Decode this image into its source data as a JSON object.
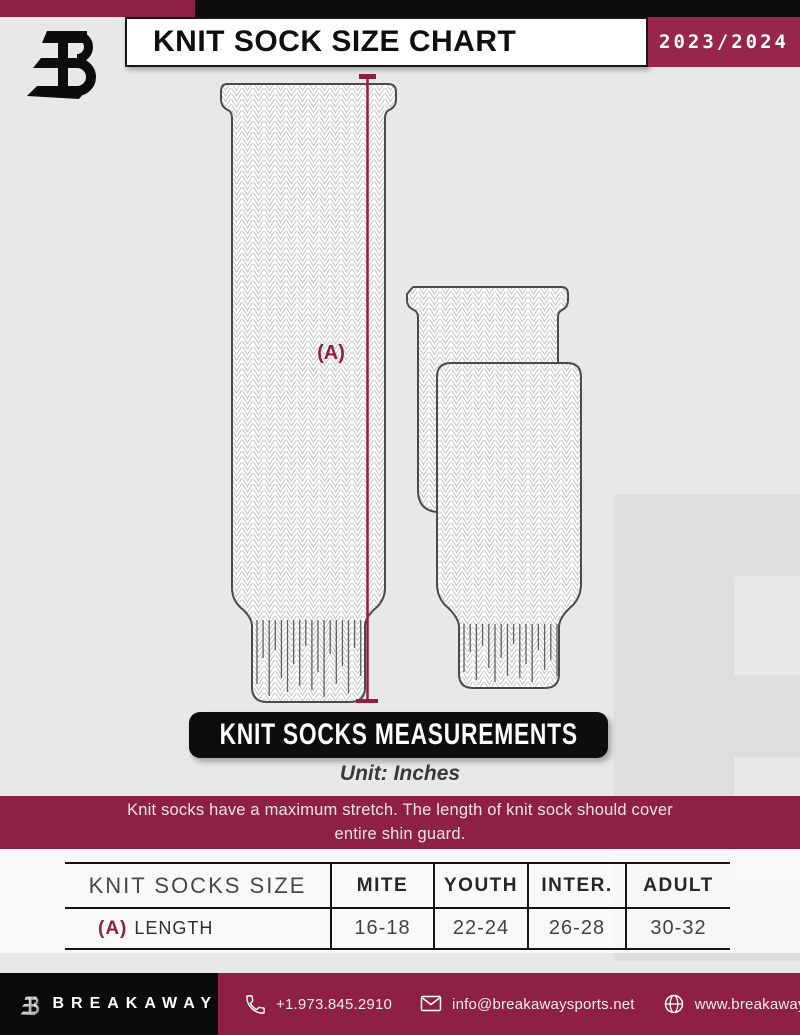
{
  "header": {
    "title": "KNIT SOCK SIZE CHART",
    "season": "2023/2024"
  },
  "diagram": {
    "measurement_label": "(A)"
  },
  "section": {
    "banner": "KNIT SOCKS MEASUREMENTS",
    "unit": "Unit: Inches",
    "note_lines": [
      "Knit socks have a maximum stretch. The length of knit sock should cover",
      "entire shin guard."
    ]
  },
  "table": {
    "size_header": "KNIT SOCKS SIZE",
    "columns": [
      "MITE",
      "YOUTH",
      "INTER.",
      "ADULT"
    ],
    "row": {
      "label_prefix": "(A)",
      "label": "LENGTH",
      "values": [
        "16-18",
        "22-24",
        "26-28",
        "30-32"
      ]
    }
  },
  "footer": {
    "brand": "BREAKAWAY",
    "phone": "+1.973.845.2910",
    "email": "info@breakawaysports.net",
    "website": "www.breakawaysports.net"
  },
  "icons": {
    "brand": "breakaway-b-logo",
    "phone": "phone-icon",
    "email": "envelope-icon",
    "website": "globe-icon"
  },
  "colors": {
    "accent": "#8e2044",
    "accent_bright": "#97264a",
    "ink": "#0d0d0d",
    "background": "#e8e8e7"
  }
}
